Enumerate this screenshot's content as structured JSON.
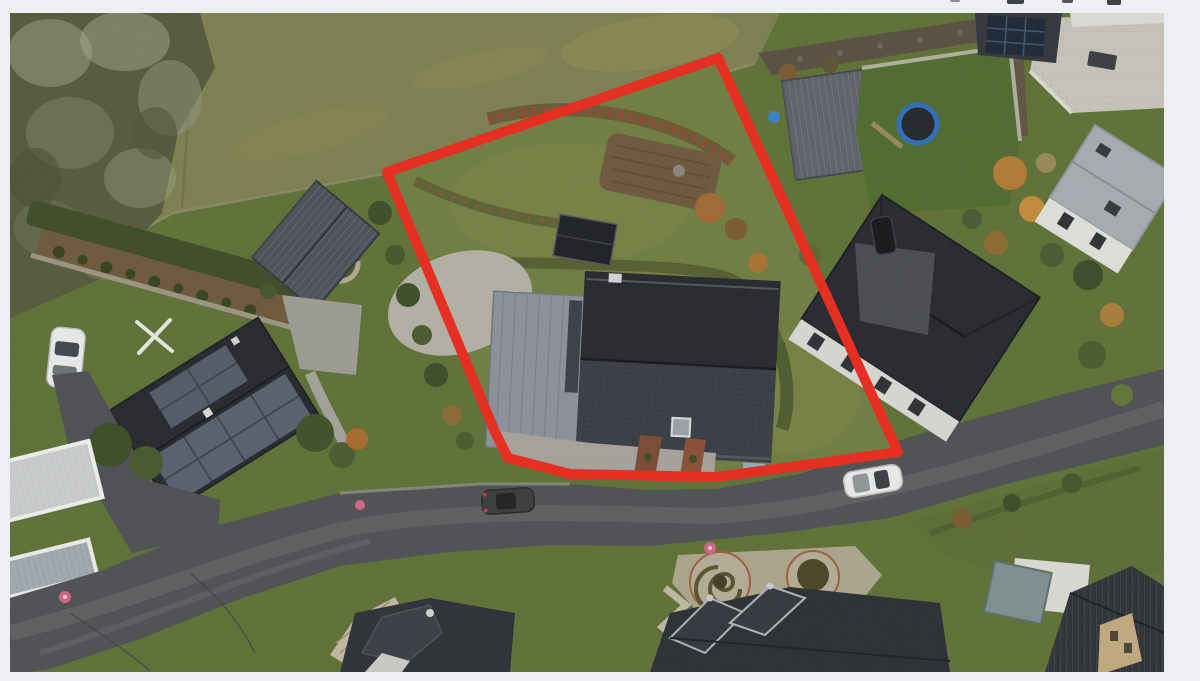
{
  "page": {
    "background_color": "#edeff2"
  },
  "toolbar": {
    "note": "four partially cut-off dark toolbar icons visible at very top edge",
    "icons": [
      {
        "name": "toolbar-icon-fragment-1"
      },
      {
        "name": "toolbar-icon-fragment-2"
      },
      {
        "name": "toolbar-icon-fragment-3"
      },
      {
        "name": "toolbar-icon-fragment-4"
      }
    ]
  },
  "photo": {
    "type": "aerial-drone-photograph",
    "description": "Top-down drone photo of a residential neighborhood: a building plot with a dark-roofed house outlined by a thick red property-boundary polygon, surrounded by a meadow, neighboring houses with dark roofs and solar panels, gardens, a trampoline, a curving asphalt road with parked cars.",
    "annotation": {
      "label": "property-boundary",
      "color": "#e62b1e",
      "stroke_width": 10,
      "polygon_points": "708,45 377,159 485,419 498,445 560,461 706,464 810,450 888,439"
    },
    "palette": {
      "meadow": "#7c7f50",
      "forest": "#565a3b",
      "plot_lawn": "#6f7d41",
      "garden_lawn": "#5e7036",
      "rich_lawn": "#4e6b2f",
      "road": "#4f5053",
      "road_worn": "#6b6b6d",
      "pavement": "#a5a39b",
      "gravel": "#b2b0a5",
      "roof_dark": "#26292e",
      "roof_mid": "#3a3e45",
      "roof_metal": "#8b9099",
      "roof_light": "#a6abb1",
      "solar": "#58606e",
      "hedge": "#3f4b28",
      "soil": "#6d583c",
      "gabion": "#584f41",
      "patio_stone": "#c6c3ba",
      "white_car": "#e8e9e9",
      "dark_car": "#3a3c3e",
      "trampoline_rim": "#2f6db8",
      "spiral_gravel": "#b3ab94",
      "pink_marker": "#cf6484"
    },
    "objects": [
      {
        "name": "property-boundary-overlay"
      },
      {
        "name": "plot-main-house"
      },
      {
        "name": "plot-driveway"
      },
      {
        "name": "plot-garden-bed"
      },
      {
        "name": "left-neighbor-house-solar"
      },
      {
        "name": "left-neighbor-shed"
      },
      {
        "name": "white-car-parked-left"
      },
      {
        "name": "rotary-dryer"
      },
      {
        "name": "right-neighbor-house"
      },
      {
        "name": "right-carport"
      },
      {
        "name": "trampoline"
      },
      {
        "name": "stone-patio"
      },
      {
        "name": "black-suv"
      },
      {
        "name": "street"
      },
      {
        "name": "dark-car-on-road"
      },
      {
        "name": "white-car-on-road"
      },
      {
        "name": "spiral-hedge-garden"
      },
      {
        "name": "bottom-houses"
      },
      {
        "name": "meadow"
      },
      {
        "name": "forest-trees"
      }
    ]
  }
}
